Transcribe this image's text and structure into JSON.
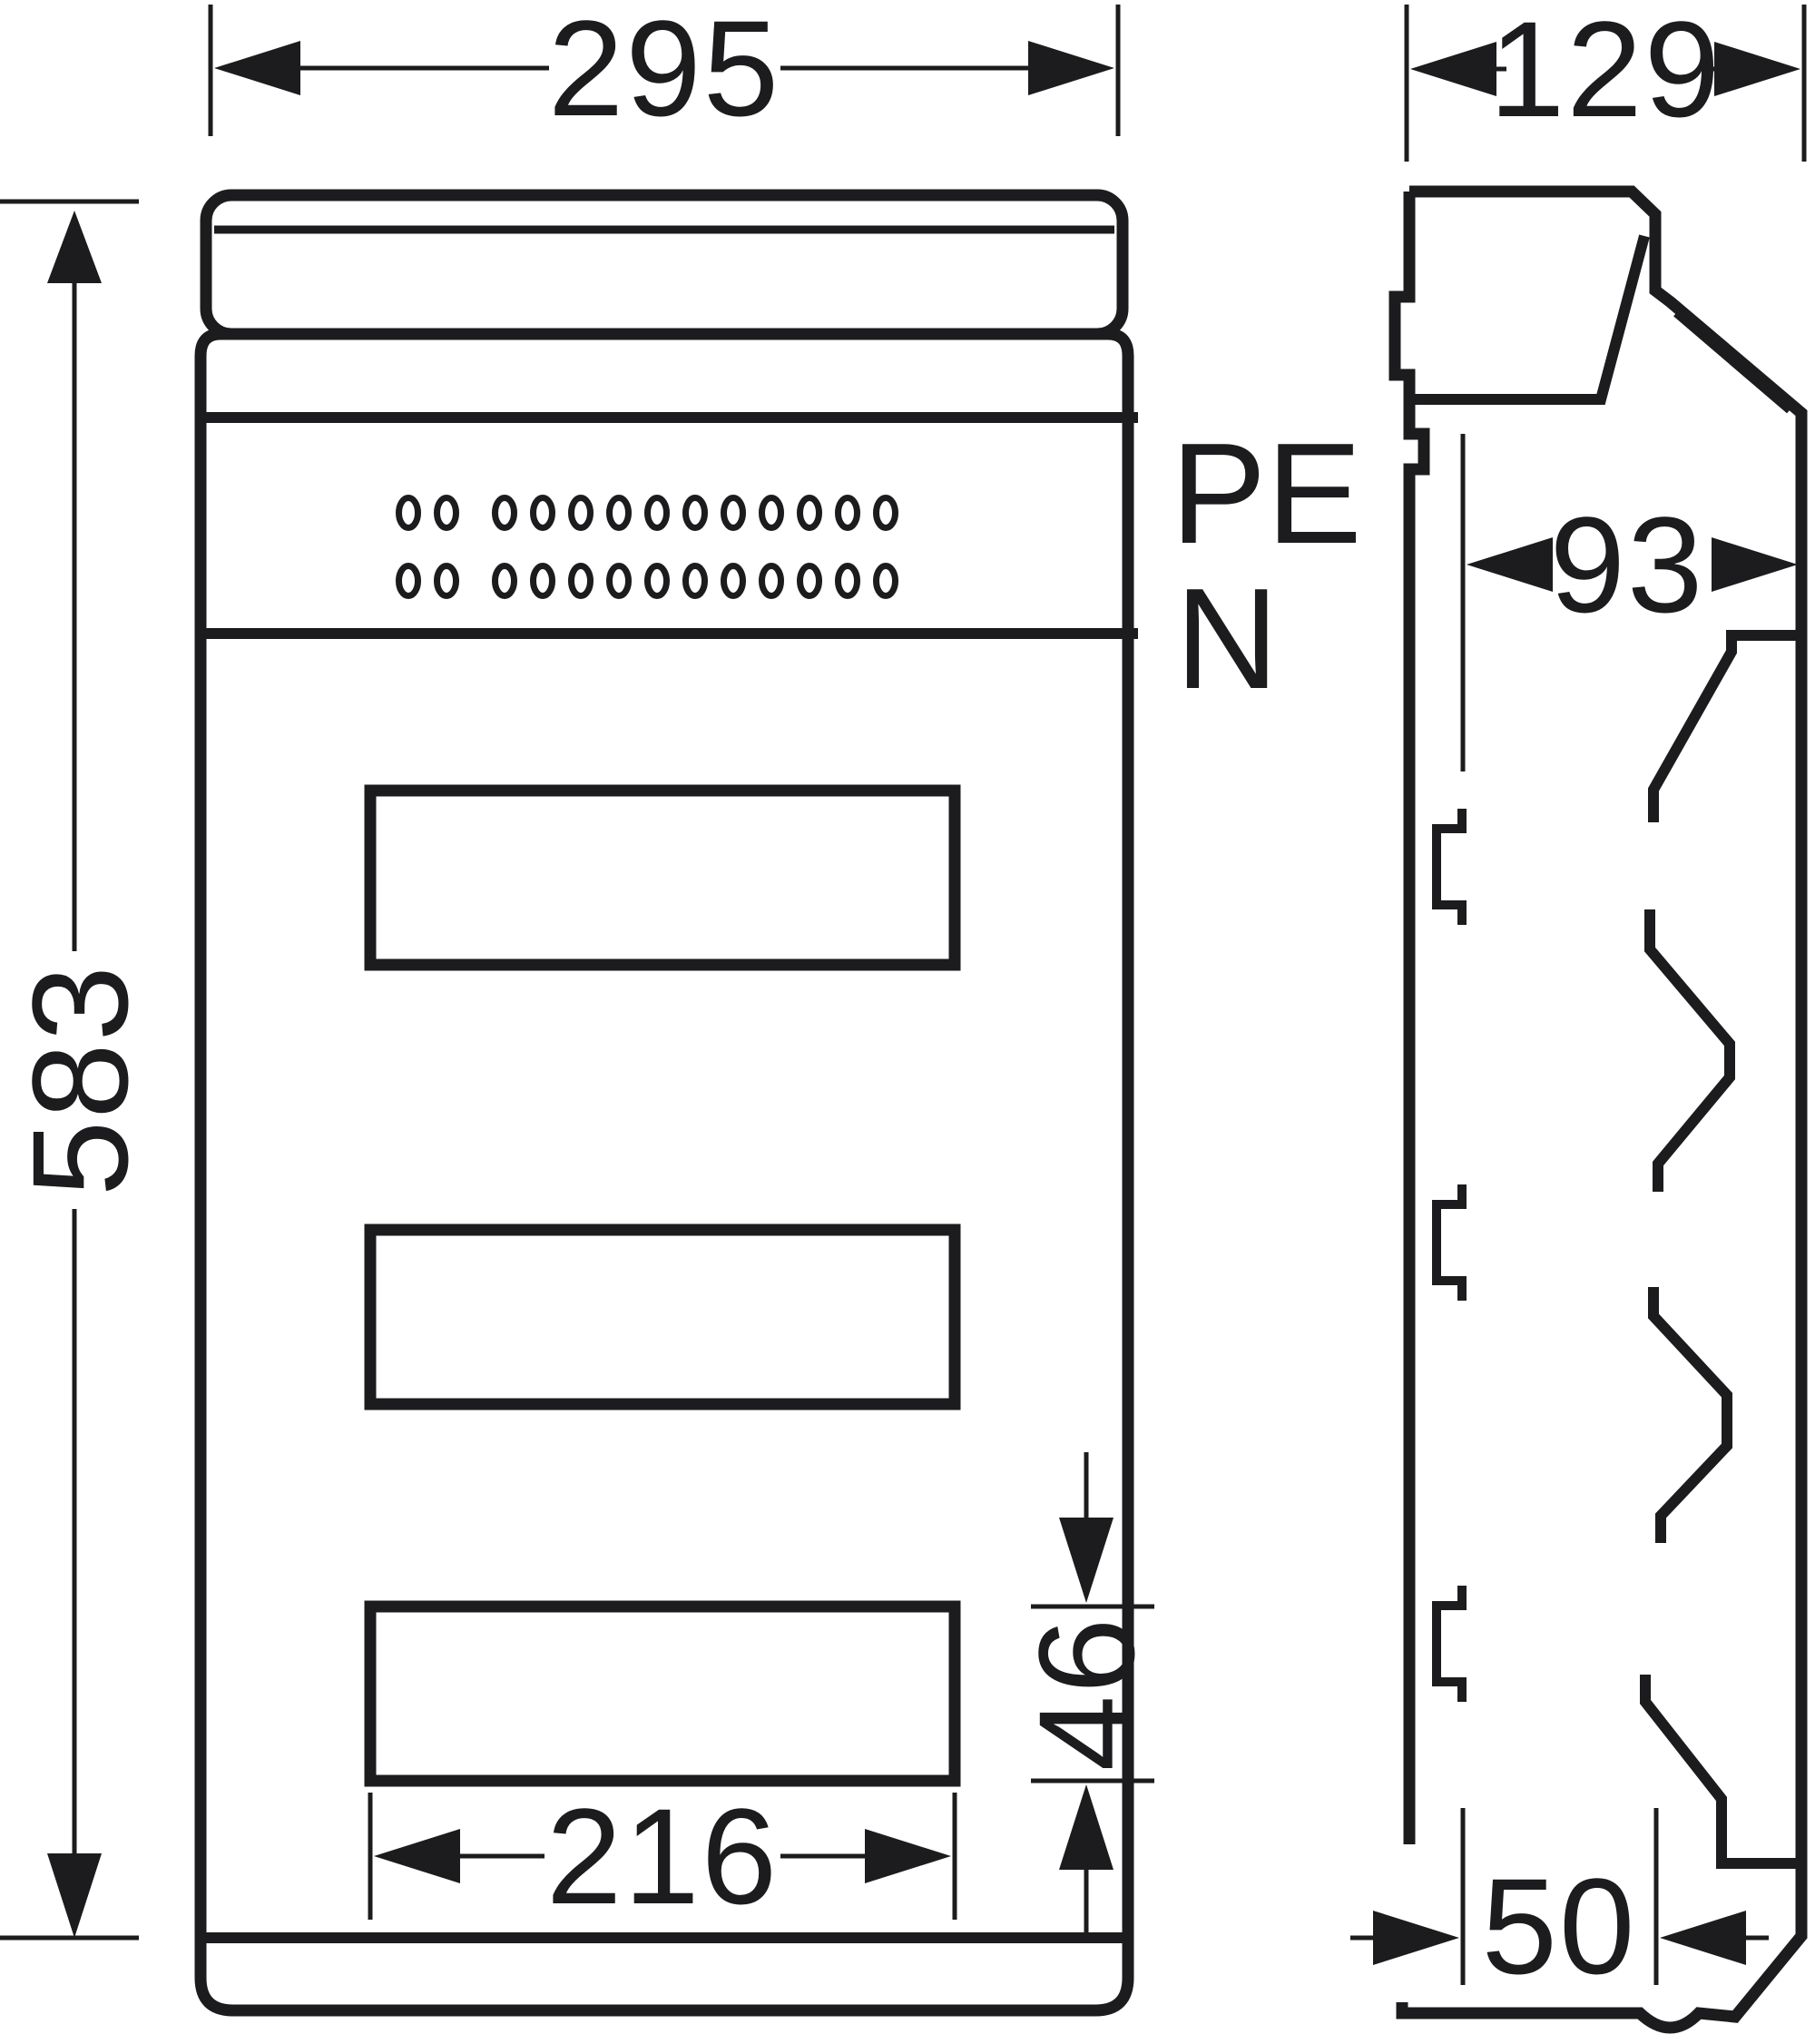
{
  "sheet": {
    "background": "#ffffff",
    "ink": "#1c1c1e"
  },
  "front_view": {
    "labels": {
      "pe": "PE",
      "n": "N"
    },
    "dimensions": {
      "overall_width": "295",
      "overall_height": "583",
      "cutout_width": "216",
      "cutout_height": "46"
    },
    "terminal_rows": [
      {
        "holes": 13
      },
      {
        "holes": 13
      }
    ],
    "cutout_count": 3
  },
  "side_view": {
    "dimensions": {
      "overall_depth": "129",
      "upper_depth": "93",
      "lower_depth": "50"
    },
    "clip_count": 3
  }
}
